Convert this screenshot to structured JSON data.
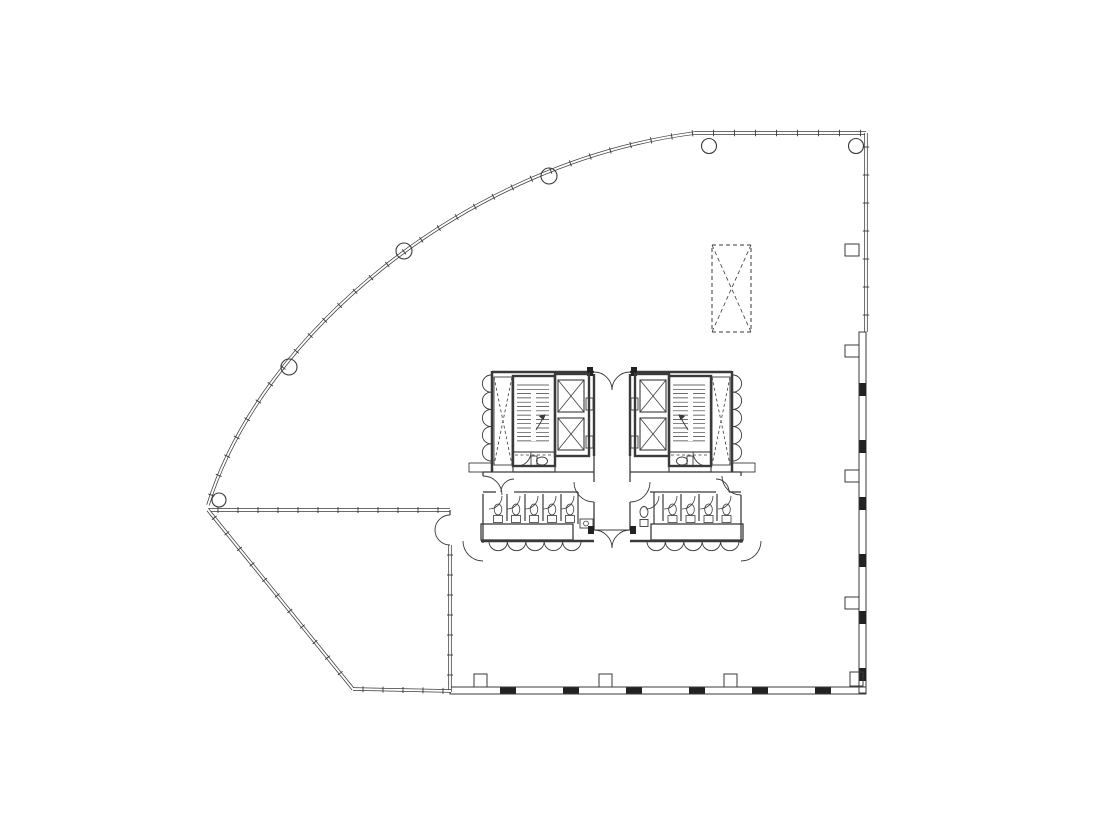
{
  "canvas": {
    "width": 1100,
    "height": 828,
    "background": "#ffffff"
  },
  "style": {
    "ink": "#3a3a3a",
    "ink_dark": "#161616",
    "ink_fill": "#222222",
    "paper": "#ffffff",
    "thin": 0.9,
    "med": 1.3,
    "thick": 2.5,
    "wall_outer": 3.4,
    "wall_inner": 1.9
  },
  "drawing": {
    "ops": [
      {
        "n": "curtain-wall-curve",
        "t": "dl",
        "d": "M208,505 C262,332 468,162 695,133 L866,133"
      },
      {
        "n": "curtain-wall-mullion-ticks",
        "t": "tk",
        "d": "M208,505 C262,332 468,162 695,133 L866,133",
        "s": 21,
        "ln": 3.2
      },
      {
        "n": "east-wall-upper",
        "t": "dl",
        "d": "M866,133 L866,332"
      },
      {
        "n": "east-wall-upper-ticks",
        "t": "tk",
        "d": "M866,133 L866,332",
        "s": 28,
        "ln": 3.2
      },
      {
        "n": "east-wall-panel-band",
        "t": "r",
        "x": 859,
        "y": 332,
        "wd": 7,
        "ht": 361,
        "w": 1
      },
      {
        "n": "east-wall-panel-joints",
        "t": "rep",
        "n5": 6,
        "dx": 0,
        "dy": 57,
        "item": {
          "t": "r",
          "x": 859.5,
          "y": 383,
          "wd": 6.5,
          "ht": 13,
          "f": "#222222"
        }
      },
      {
        "n": "south-wall-panel-band",
        "t": "r",
        "x": 450,
        "y": 687,
        "wd": 416,
        "ht": 7,
        "w": 1
      },
      {
        "n": "south-wall-panel-joints",
        "t": "rep",
        "n5": 6,
        "dx": 63,
        "dy": 0,
        "item": {
          "t": "r",
          "x": 500,
          "y": 687.5,
          "wd": 16,
          "ht": 6,
          "f": "#222222"
        }
      },
      {
        "n": "east-column-fin-1",
        "t": "r",
        "x": 845,
        "y": 244,
        "wd": 14,
        "ht": 12,
        "w": 1
      },
      {
        "n": "east-column-fin-2",
        "t": "r",
        "x": 845,
        "y": 345,
        "wd": 14,
        "ht": 12,
        "w": 1
      },
      {
        "n": "east-column-fin-3",
        "t": "r",
        "x": 845,
        "y": 470,
        "wd": 14,
        "ht": 12,
        "w": 1
      },
      {
        "n": "east-column-fin-4",
        "t": "r",
        "x": 845,
        "y": 597,
        "wd": 14,
        "ht": 12,
        "w": 1
      },
      {
        "n": "south-column-fins",
        "t": "rep",
        "n5": 3,
        "dx": 125,
        "dy": 0,
        "item": {
          "t": "r",
          "x": 474,
          "y": 674,
          "wd": 13,
          "ht": 13,
          "w": 1
        }
      },
      {
        "n": "southeast-corner-fin",
        "t": "r",
        "x": 850,
        "y": 672,
        "wd": 13,
        "ht": 14,
        "w": 1
      },
      {
        "n": "column-apex",
        "t": "c",
        "x": 219,
        "y": 500,
        "r": 7,
        "w": 1.1
      },
      {
        "n": "column-curve-2",
        "t": "c",
        "x": 289,
        "y": 367,
        "r": 8,
        "w": 1.1
      },
      {
        "n": "column-curve-3",
        "t": "c",
        "x": 404,
        "y": 251,
        "r": 8,
        "w": 1.1
      },
      {
        "n": "column-curve-4",
        "t": "c",
        "x": 549,
        "y": 176,
        "r": 8,
        "w": 1.1
      },
      {
        "n": "column-top-1",
        "t": "c",
        "x": 709,
        "y": 146,
        "r": 7.5,
        "w": 1.1
      },
      {
        "n": "column-top-2",
        "t": "c",
        "x": 856,
        "y": 146,
        "r": 7.5,
        "w": 1.1
      },
      {
        "n": "terrace-wall-north",
        "t": "dl",
        "d": "M208,510 L450,510"
      },
      {
        "n": "terrace-wall-north-ticks",
        "t": "tk",
        "d": "M208,510 L450,510",
        "s": 20,
        "ln": 3
      },
      {
        "n": "terrace-wall-east",
        "t": "dl",
        "d": "M450,545 L450,692"
      },
      {
        "n": "terrace-wall-east-ticks",
        "t": "tk",
        "d": "M450,545 L450,692",
        "s": 20,
        "ln": 3
      },
      {
        "n": "terrace-wall-east-stub",
        "t": "l",
        "x1": 450,
        "y1": 510,
        "x2": 450,
        "y2": 515,
        "w": 1.2
      },
      {
        "n": "terrace-double-door-leaf-1",
        "t": "p",
        "d": "M435,530 A15 15 0 0 1 450,515"
      },
      {
        "n": "terrace-double-door-leaf-2",
        "t": "p",
        "d": "M435,530 A15 15 0 0 0 450,545"
      },
      {
        "n": "terrace-wall-angled",
        "t": "dl",
        "d": "M208,510 L353,689"
      },
      {
        "n": "terrace-wall-angled-ticks",
        "t": "tk",
        "d": "M208,510 L353,689",
        "s": 20,
        "ln": 3
      },
      {
        "n": "terrace-wall-south",
        "t": "dl",
        "d": "M353,689 L451,691"
      },
      {
        "n": "terrace-wall-south-ticks",
        "t": "tk",
        "d": "M353,689 L451,691",
        "s": 20,
        "ln": 3
      },
      {
        "n": "future-shaft-dashed-box",
        "t": "xb",
        "x": 712,
        "y": 245,
        "wd": 39,
        "ht": 87,
        "w": 1,
        "da": "4 3",
        "daBox": true
      },
      {
        "n": "core-west-wall",
        "t": "l",
        "x1": 492,
        "y1": 371,
        "x2": 492,
        "y2": 472,
        "w": 2.5
      },
      {
        "n": "core-west-closet-doors",
        "t": "row",
        "x": 491,
        "y": 375,
        "n5": 5,
        "r": 8.6,
        "step": 17.2,
        "sweep": 0,
        "vert": true
      },
      {
        "n": "core-top-wall-left",
        "t": "l",
        "x1": 492,
        "y1": 372,
        "x2": 594,
        "y2": 372,
        "w": 2.5
      },
      {
        "n": "core-top-wall-right",
        "t": "l",
        "x1": 630,
        "y1": 372,
        "x2": 732,
        "y2": 372,
        "w": 2.5
      },
      {
        "n": "lobby-north-door-leaf-1",
        "t": "p",
        "d": "M594,372 A18 18 0 0 1 612,390"
      },
      {
        "n": "lobby-north-door-leaf-2",
        "t": "p",
        "d": "M630,372 A18 18 0 0 0 612,390"
      },
      {
        "n": "lobby-north-jamb-1",
        "t": "r",
        "x": 587,
        "y": 367,
        "wd": 6,
        "ht": 9,
        "f": "#222222"
      },
      {
        "n": "lobby-north-jamb-2",
        "t": "r",
        "x": 631,
        "y": 367,
        "wd": 6,
        "ht": 9,
        "f": "#222222"
      },
      {
        "n": "vent-shaft-left",
        "t": "xb",
        "x": 494,
        "y": 377,
        "wd": 18,
        "ht": 88,
        "w": 0.9,
        "da": "3 2.5"
      },
      {
        "n": "stair-left",
        "t": "r",
        "x": 513,
        "y": 376,
        "wd": 42,
        "ht": 90,
        "w": 2.4
      },
      {
        "n": "stair-left-treads",
        "t": "hat",
        "x": 517,
        "y": 385,
        "wd": 32,
        "ht": 56,
        "step": 4.3
      },
      {
        "n": "stair-left-rail",
        "t": "r",
        "x": 531,
        "y": 391,
        "wd": 5,
        "ht": 50,
        "w": 0.9,
        "f": "#ffffff"
      },
      {
        "n": "stair-left-arrow",
        "t": "p",
        "d": "M536,430 L545,415"
      },
      {
        "n": "stair-left-arrowhead",
        "t": "p",
        "d": "M545,415 l-5.2,1.2 l3.4,3.4 Z",
        "f": "#3a3a3a"
      },
      {
        "n": "elevator-bank-left",
        "t": "r",
        "x": 555,
        "y": 374,
        "wd": 34,
        "ht": 82,
        "w": 2.4
      },
      {
        "n": "elevator-car-left-1",
        "t": "xb",
        "x": 558,
        "y": 380,
        "wd": 26,
        "ht": 32,
        "w": 1.1
      },
      {
        "n": "elevator-car-left-2",
        "t": "xb",
        "x": 558,
        "y": 418,
        "wd": 26,
        "ht": 32,
        "w": 1.1
      },
      {
        "n": "elevator-doors-left",
        "t": "rep",
        "n5": 2,
        "dx": 0,
        "dy": 38,
        "item": {
          "t": "r",
          "x": 586,
          "y": 398,
          "wd": 7,
          "ht": 12,
          "w": 0.9
        }
      },
      {
        "n": "wc-room-left",
        "t": "r",
        "x": 513,
        "y": 452,
        "wd": 42,
        "ht": 20,
        "w": 1.1
      },
      {
        "n": "wc-room-left-dashline",
        "t": "l",
        "x1": 515,
        "y1": 455,
        "x2": 553,
        "y2": 455,
        "w": 0.8,
        "da": "3 2.5"
      },
      {
        "n": "wc-left-tank",
        "t": "r",
        "x": 531,
        "y": 456,
        "wd": 6,
        "ht": 10,
        "w": 0.9
      },
      {
        "n": "wc-left-bowl",
        "t": "e",
        "x": 542,
        "y": 461,
        "rx": 5.5,
        "ry": 4,
        "w": 0.9
      },
      {
        "n": "wc-left-door",
        "t": "p",
        "d": "M531,452 A14 14 0 0 1 517,466"
      },
      {
        "n": "core-west-stub",
        "t": "r",
        "x": 469,
        "y": 463,
        "wd": 23,
        "ht": 9,
        "w": 0.9
      },
      {
        "n": "circulation-north-wall-left",
        "t": "l",
        "x1": 483,
        "y1": 472,
        "x2": 594,
        "y2": 472,
        "w": 1.3
      },
      {
        "n": "circulation-north-wall-right",
        "t": "l",
        "x1": 630,
        "y1": 472,
        "x2": 741,
        "y2": 472,
        "w": 1.3
      },
      {
        "n": "restroom-west-wall",
        "t": "l",
        "x1": 483,
        "y1": 494,
        "x2": 483,
        "y2": 543,
        "w": 1.3
      },
      {
        "n": "restroom-west-wall-stub",
        "t": "l",
        "x1": 483,
        "y1": 472,
        "x2": 483,
        "y2": 476,
        "w": 1.3
      },
      {
        "n": "restroom-west-entry-door",
        "t": "p",
        "d": "M483,476 A19 19 0 0 1 502,495"
      },
      {
        "n": "restroom-left-top-wall-a",
        "t": "l",
        "x1": 483,
        "y1": 492,
        "x2": 496,
        "y2": 492,
        "w": 1.3
      },
      {
        "n": "restroom-left-top-wall-b",
        "t": "l",
        "x1": 514,
        "y1": 492,
        "x2": 578,
        "y2": 492,
        "w": 1.3
      },
      {
        "n": "restroom-left-entry-swing",
        "t": "p",
        "d": "M501,492 A13 13 0 0 1 514,479"
      },
      {
        "n": "stall-partitions-left",
        "t": "rep",
        "n5": 4,
        "dx": 18,
        "dy": 0,
        "item": {
          "t": "l",
          "x1": 507,
          "y1": 494,
          "x2": 507,
          "y2": 521,
          "w": 1.2
        }
      },
      {
        "n": "stall-doors-left",
        "t": "doorrow",
        "x": 489,
        "y": 496,
        "n5": 5,
        "dx": 18,
        "r": 13,
        "flip": false
      },
      {
        "n": "toilets-left",
        "t": "rep",
        "n5": 5,
        "dx": 18,
        "dy": 0,
        "item": {
          "t": "wc",
          "x": 498,
          "y": 513
        }
      },
      {
        "n": "plumbing-chase-left",
        "t": "r",
        "x": 481,
        "y": 524,
        "wd": 92,
        "ht": 16,
        "w": 1.3
      },
      {
        "n": "sink-row-left",
        "t": "row",
        "x": 489,
        "y": 541.5,
        "n5": 5,
        "r": 9.2,
        "step": 18.4,
        "sweep": 0,
        "vert": false
      },
      {
        "n": "core-south-wall-left",
        "t": "l",
        "x1": 481,
        "y1": 541,
        "x2": 594,
        "y2": 541,
        "w": 2.4
      },
      {
        "n": "core-sw-door",
        "t": "p",
        "d": "M463,541 A20 20 0 0 0 483,561"
      },
      {
        "n": "vestibule-wall-left",
        "t": "l",
        "x1": 578,
        "y1": 492,
        "x2": 578,
        "y2": 524,
        "w": 1.2
      },
      {
        "n": "mop-sink",
        "t": "r",
        "x": 580,
        "y": 519,
        "wd": 13,
        "ht": 9,
        "w": 0.9
      },
      {
        "n": "mop-sink-drain",
        "t": "c",
        "x": 586,
        "y": 523.5,
        "r": 2.4,
        "w": 0.8
      },
      {
        "n": "corridor-west-wall-hi",
        "t": "l",
        "x1": 594,
        "y1": 374,
        "x2": 594,
        "y2": 456,
        "w": 2.4
      },
      {
        "n": "corridor-west-wall-mid",
        "t": "l",
        "x1": 594,
        "y1": 456,
        "x2": 594,
        "y2": 482,
        "w": 1.3
      },
      {
        "n": "corridor-west-wall-low",
        "t": "l",
        "x1": 594,
        "y1": 502,
        "x2": 594,
        "y2": 530,
        "w": 1.3
      },
      {
        "n": "vestibule-door-left",
        "t": "p",
        "d": "M574,482 A20 20 0 0 0 594,502"
      },
      {
        "n": "corridor-east-wall-hi",
        "t": "l",
        "x1": 630,
        "y1": 374,
        "x2": 630,
        "y2": 456,
        "w": 2.4
      },
      {
        "n": "corridor-east-wall-mid",
        "t": "l",
        "x1": 630,
        "y1": 456,
        "x2": 630,
        "y2": 482,
        "w": 1.3
      },
      {
        "n": "corridor-east-wall-low",
        "t": "l",
        "x1": 630,
        "y1": 502,
        "x2": 630,
        "y2": 530,
        "w": 1.3
      },
      {
        "n": "accessible-wc-door",
        "t": "p",
        "d": "M650,482 A20 20 0 0 1 630,502"
      },
      {
        "n": "corridor-south-header",
        "t": "l",
        "x1": 594,
        "y1": 530,
        "x2": 630,
        "y2": 530,
        "w": 1.1
      },
      {
        "n": "lobby-south-door-leaf-1",
        "t": "p",
        "d": "M594,530 A18 18 0 0 1 612,548"
      },
      {
        "n": "lobby-south-door-leaf-2",
        "t": "p",
        "d": "M630,530 A18 18 0 0 0 612,548"
      },
      {
        "n": "lobby-south-jamb-1",
        "t": "r",
        "x": 588,
        "y": 526,
        "wd": 6,
        "ht": 8,
        "f": "#222222"
      },
      {
        "n": "lobby-south-jamb-2",
        "t": "r",
        "x": 630,
        "y": 526,
        "wd": 6,
        "ht": 8,
        "f": "#222222"
      },
      {
        "n": "core-east-wall",
        "t": "l",
        "x1": 732,
        "y1": 371,
        "x2": 732,
        "y2": 472,
        "w": 2.5
      },
      {
        "n": "core-east-closet-doors",
        "t": "row",
        "x": 733,
        "y": 375,
        "n5": 5,
        "r": 8.6,
        "step": 17.2,
        "sweep": 1,
        "vert": true
      },
      {
        "n": "vent-shaft-right",
        "t": "xb",
        "x": 712,
        "y": 377,
        "wd": 18,
        "ht": 88,
        "w": 0.9,
        "da": "3 2.5"
      },
      {
        "n": "stair-right",
        "t": "r",
        "x": 669,
        "y": 376,
        "wd": 42,
        "ht": 90,
        "w": 2.4
      },
      {
        "n": "stair-right-treads",
        "t": "hat",
        "x": 673,
        "y": 385,
        "wd": 32,
        "ht": 56,
        "step": 4.3
      },
      {
        "n": "stair-right-rail",
        "t": "r",
        "x": 688,
        "y": 391,
        "wd": 5,
        "ht": 50,
        "w": 0.9,
        "f": "#ffffff"
      },
      {
        "n": "stair-right-arrow",
        "t": "p",
        "d": "M688,430 L679,415"
      },
      {
        "n": "stair-right-arrowhead",
        "t": "p",
        "d": "M679,415 l5.2,1.2 l-3.4,3.4 Z",
        "f": "#3a3a3a"
      },
      {
        "n": "elevator-bank-right",
        "t": "r",
        "x": 635,
        "y": 374,
        "wd": 34,
        "ht": 82,
        "w": 2.4
      },
      {
        "n": "elevator-car-right-1",
        "t": "xb",
        "x": 640,
        "y": 380,
        "wd": 26,
        "ht": 32,
        "w": 1.1
      },
      {
        "n": "elevator-car-right-2",
        "t": "xb",
        "x": 640,
        "y": 418,
        "wd": 26,
        "ht": 32,
        "w": 1.1
      },
      {
        "n": "elevator-doors-right",
        "t": "rep",
        "n5": 2,
        "dx": 0,
        "dy": 38,
        "item": {
          "t": "r",
          "x": 631,
          "y": 398,
          "wd": 7,
          "ht": 12,
          "w": 0.9
        }
      },
      {
        "n": "wc-room-right",
        "t": "r",
        "x": 669,
        "y": 452,
        "wd": 42,
        "ht": 20,
        "w": 1.1
      },
      {
        "n": "wc-room-right-dashline",
        "t": "l",
        "x1": 671,
        "y1": 455,
        "x2": 709,
        "y2": 455,
        "w": 0.8,
        "da": "3 2.5"
      },
      {
        "n": "wc-right-tank",
        "t": "r",
        "x": 687,
        "y": 456,
        "wd": 6,
        "ht": 10,
        "w": 0.9
      },
      {
        "n": "wc-right-bowl",
        "t": "e",
        "x": 682,
        "y": 461,
        "rx": 5.5,
        "ry": 4,
        "w": 0.9
      },
      {
        "n": "wc-right-door",
        "t": "p",
        "d": "M693,452 A14 14 0 0 0 707,466"
      },
      {
        "n": "core-east-stub",
        "t": "r",
        "x": 732,
        "y": 463,
        "wd": 23,
        "ht": 9,
        "w": 0.9
      },
      {
        "n": "restroom-east-wall",
        "t": "l",
        "x1": 741,
        "y1": 495,
        "x2": 741,
        "y2": 543,
        "w": 1.3
      },
      {
        "n": "restroom-east-wall-stub",
        "t": "l",
        "x1": 741,
        "y1": 472,
        "x2": 741,
        "y2": 476,
        "w": 1.3
      },
      {
        "n": "restroom-east-entry-door",
        "t": "p",
        "d": "M722,476 A19 19 0 0 0 741,495"
      },
      {
        "n": "restroom-right-top-wall-a",
        "t": "l",
        "x1": 650,
        "y1": 492,
        "x2": 716,
        "y2": 492,
        "w": 1.3
      },
      {
        "n": "restroom-right-top-wall-b",
        "t": "l",
        "x1": 729,
        "y1": 492,
        "x2": 741,
        "y2": 492,
        "w": 1.3
      },
      {
        "n": "restroom-right-entry-swing",
        "t": "p",
        "d": "M729,492 A13 13 0 0 0 716,479"
      },
      {
        "n": "accessible-wc-wall",
        "t": "l",
        "x1": 654,
        "y1": 492,
        "x2": 654,
        "y2": 524,
        "w": 1.2
      },
      {
        "n": "accessible-wc-bowl",
        "t": "e",
        "x": 644,
        "y": 512,
        "rx": 4,
        "ry": 5.5,
        "w": 0.9
      },
      {
        "n": "accessible-wc-tank",
        "t": "r",
        "x": 640,
        "y": 519.5,
        "wd": 8,
        "ht": 7,
        "w": 0.9
      },
      {
        "n": "stall-partitions-right",
        "t": "rep",
        "n5": 4,
        "dx": 18,
        "dy": 0,
        "item": {
          "t": "l",
          "x1": 663,
          "y1": 494,
          "x2": 663,
          "y2": 521,
          "w": 1.2
        }
      },
      {
        "n": "stall-doors-right",
        "t": "doorrow",
        "x": 646,
        "y": 496,
        "n5": 5,
        "dx": 18,
        "r": 13,
        "flip": false
      },
      {
        "n": "toilets-right",
        "t": "rep",
        "n5": 4,
        "dx": 18,
        "dy": 0,
        "item": {
          "t": "wc",
          "x": 672.5,
          "y": 513
        }
      },
      {
        "n": "plumbing-chase-right",
        "t": "r",
        "x": 651,
        "y": 524,
        "wd": 92,
        "ht": 16,
        "w": 1.3
      },
      {
        "n": "sink-row-right",
        "t": "row",
        "x": 647,
        "y": 541.5,
        "n5": 5,
        "r": 9.2,
        "step": 18.4,
        "sweep": 0,
        "vert": false
      },
      {
        "n": "core-south-wall-right",
        "t": "l",
        "x1": 630,
        "y1": 541,
        "x2": 743,
        "y2": 541,
        "w": 2.4
      },
      {
        "n": "core-se-door",
        "t": "p",
        "d": "M761,541 A20 20 0 0 1 741,561"
      }
    ]
  }
}
